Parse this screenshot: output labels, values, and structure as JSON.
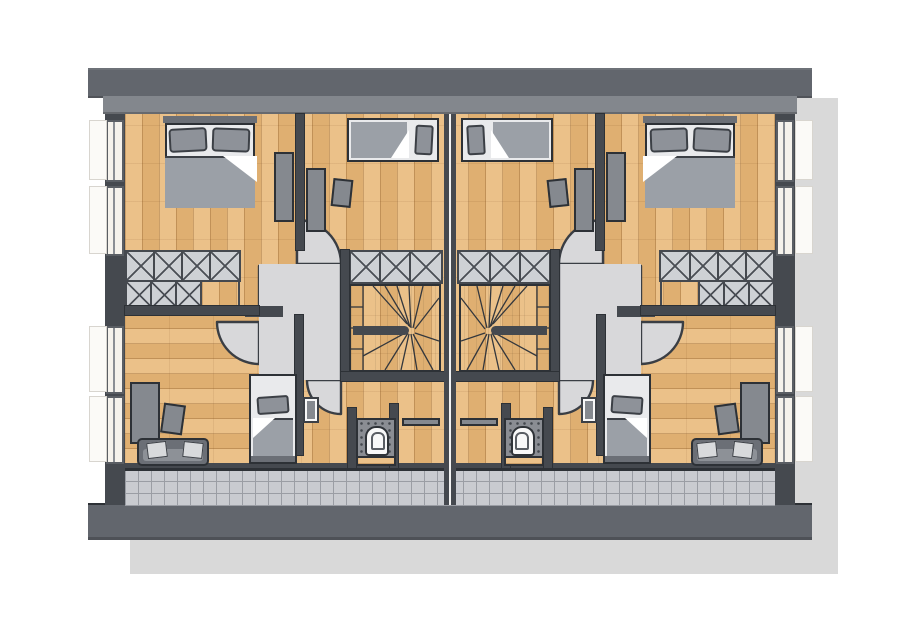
{
  "meta": {
    "description": "Hand-drawn style architectural floor plan: upper storey of a semi-detached duplex house, two mirrored units separated by a double party wall, balcony terrace along the bottom",
    "units_count": 2,
    "mirrored": true
  },
  "palette": {
    "background": "#ffffff",
    "shadow": "#d9d9d9",
    "band_outer": "#62666d",
    "band_inner": "#83878d",
    "wall": "#45494f",
    "wall_line": "#2d3136",
    "wood": "#e9ba7c",
    "floor_gray": "#d8d8da",
    "stair_light": "#c2c3c6",
    "stair_dark": "#8e8f93",
    "tile": "#c9cbd0",
    "tile_line": "#9a9da4",
    "closet_fill": "#ced1d5",
    "furniture": "#85898f",
    "furniture_dark": "#6b6f76",
    "textile": "#9ba0a7",
    "pillow": "#8e9299",
    "mattress": "#e9eaec",
    "mat": "#8a8d93",
    "white_goods": "#f8f8f8",
    "window": "#f5f2ec",
    "sill": "#fbfaf7"
  },
  "legend": {
    "rooms_per_unit": [
      "bedroom-outer-top",
      "bedroom-inner-top",
      "hallway-landing-with-door-swings",
      "winder-staircase",
      "bedroom-bottom",
      "wc",
      "balcony-terrace"
    ],
    "elements_per_unit": [
      "double-bed",
      "single-bed-horizontal",
      "single-bed-vertical",
      "desk",
      "desk-chair",
      "x-hatched-closet-row",
      "sofa-with-cushions",
      "wardrobe",
      "toilet-on-dotted-mat",
      "wooden-bench",
      "radiator-shelf",
      "open-door-leaf",
      "window-with-sill"
    ],
    "window_count_per_side_wall": 4
  }
}
